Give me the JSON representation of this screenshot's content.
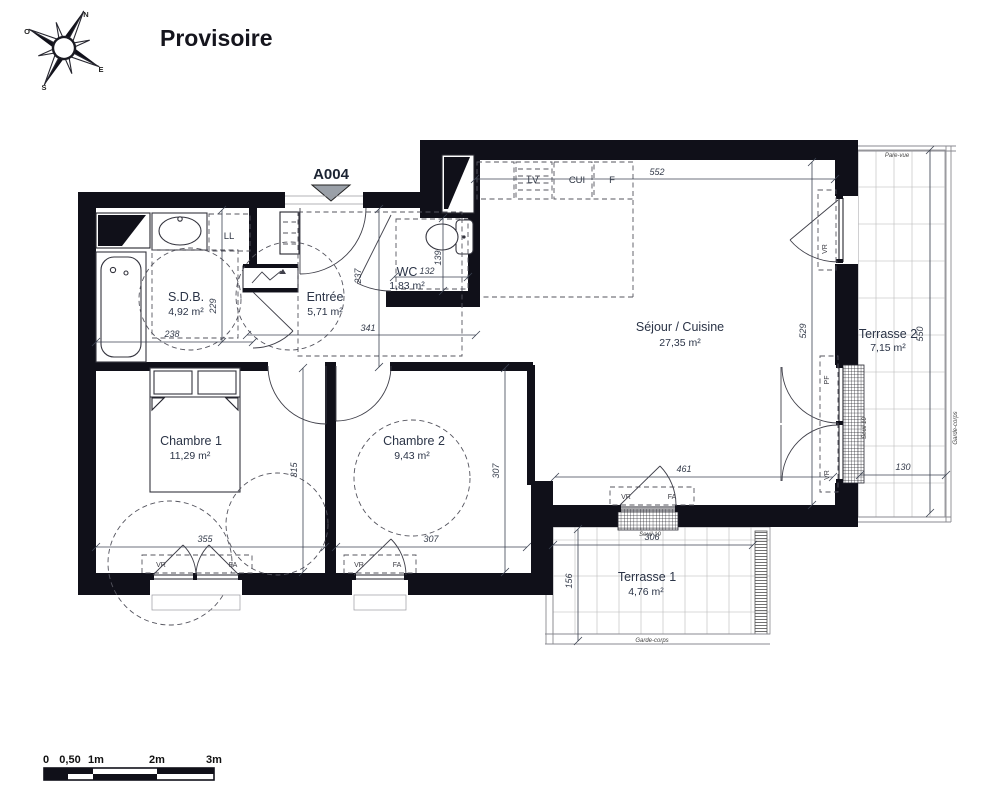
{
  "title": "Provisoire",
  "unit_label": "A004",
  "compass": {
    "n": "N",
    "s": "S",
    "e": "E",
    "o": "O"
  },
  "rooms": {
    "sdb": {
      "name": "S.D.B.",
      "area": "4,92 m²"
    },
    "entree": {
      "name": "Entrée",
      "area": "5,71 m²"
    },
    "wc": {
      "name": "WC",
      "area": "1,83 m²"
    },
    "sejour": {
      "name": "Séjour / Cuisine",
      "area": "27,35 m²"
    },
    "chambre1": {
      "name": "Chambre 1",
      "area": "11,29 m²"
    },
    "chambre2": {
      "name": "Chambre 2",
      "area": "9,43 m²"
    },
    "terrasse1": {
      "name": "Terrasse 1",
      "area": "4,76 m²"
    },
    "terrasse2": {
      "name": "Terrasse 2",
      "area": "7,15 m²"
    }
  },
  "dimensions": {
    "sdb_w": "238",
    "sdb_h": "229",
    "entree_w": "341",
    "entree_h": "237",
    "wc_w": "132",
    "wc_h": "139",
    "kitchen_w": "552",
    "sejour_h": "529",
    "sejour_w": "461",
    "t2_h": "550",
    "t2_w": "130",
    "t1_w": "306",
    "t1_h": "156",
    "ch1_w": "355",
    "ch1_h": "315",
    "ch2_w": "307",
    "ch2_h": "307"
  },
  "labels": {
    "ll": "LL",
    "lv": "LV",
    "cui": "CUI",
    "f": "F",
    "vr": "VR",
    "fa": "FA",
    "pf": "PF",
    "pare_vue": "Pare-vue",
    "garde_corps": "Garde-corps",
    "seuil": "Seuil 10"
  },
  "scale_bar": {
    "t0": "0",
    "t05": "0,50",
    "t1": "1m",
    "t2": "2m",
    "t3": "3m"
  }
}
